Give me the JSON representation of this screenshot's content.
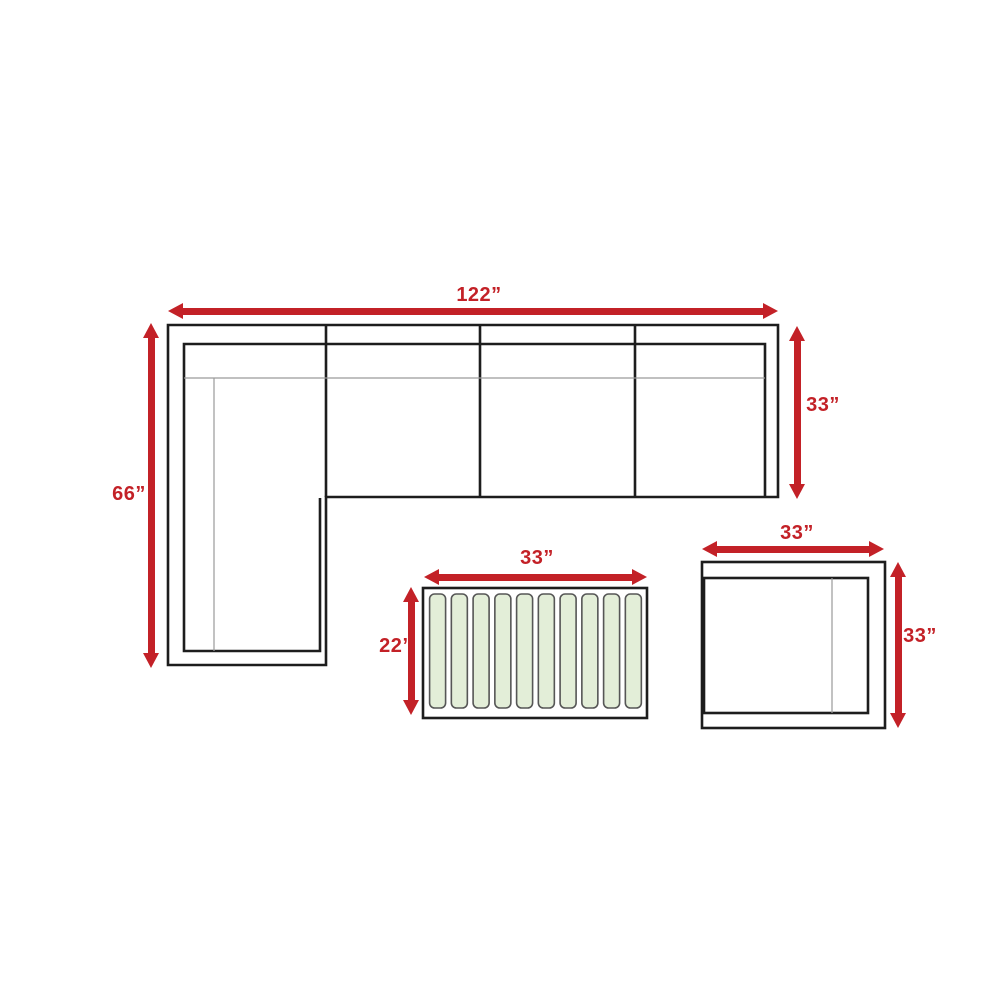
{
  "colors": {
    "dimension_red": "#c32127",
    "outline_black": "#1d1d1d",
    "seam_gray": "#9a9a9a",
    "slat_fill": "#e3eed8",
    "slat_border": "#565656",
    "background": "#ffffff"
  },
  "furniture": {
    "sectional_sofa": {
      "width_label": "122”",
      "height_label": "66”",
      "depth_label": "33”",
      "seat_sections": 4
    },
    "coffee_table": {
      "width_label": "33”",
      "depth_label": "22”",
      "slat_count": 10
    },
    "side_chair": {
      "width_label": "33”",
      "depth_label": "33”"
    }
  }
}
